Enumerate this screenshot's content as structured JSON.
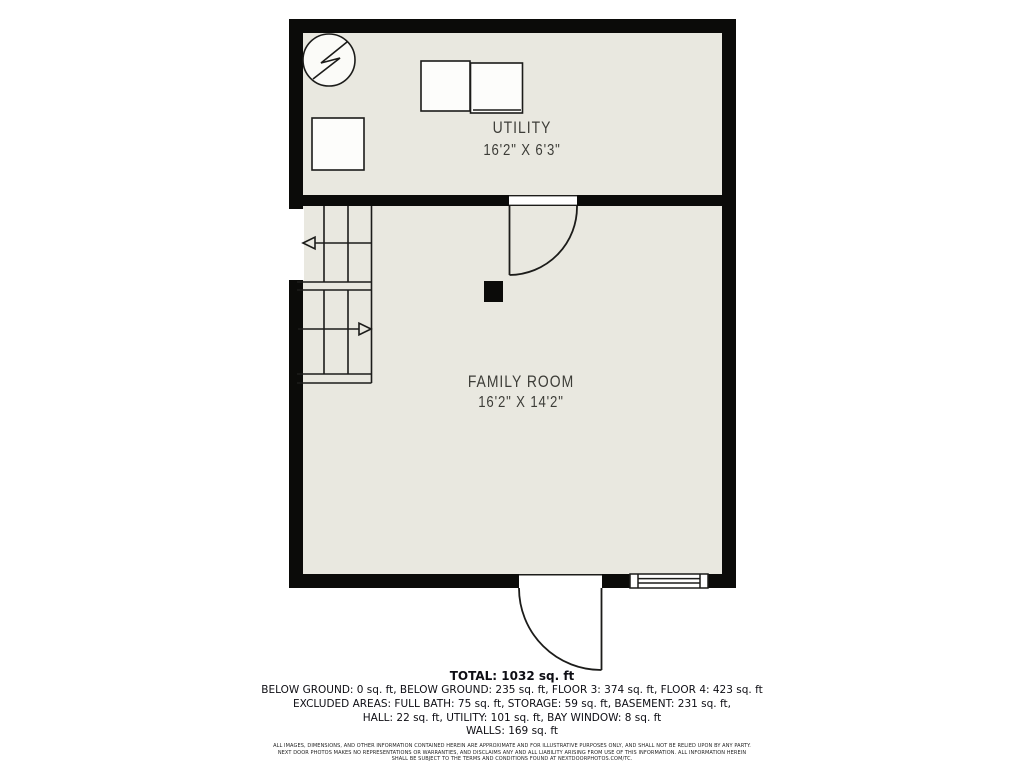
{
  "colors": {
    "page_bg": "#ffffff",
    "floor": "#e9e8e0",
    "wall": "#0b0b09",
    "line": "#1c1c1a",
    "label_text": "#3d3d38",
    "summary_text": "#0e0e14"
  },
  "plan": {
    "rooms": [
      {
        "name": "UTILITY",
        "dims": "16'2\" X 6'3\""
      },
      {
        "name": "FAMILY ROOM",
        "dims": "16'2\" X 14'2\""
      }
    ],
    "symbols": [
      "electrical-panel",
      "appliance-box-left",
      "appliance-box-right",
      "appliance-box-small",
      "staircase-up-arrow",
      "staircase-down-arrow",
      "interior-door-swing",
      "exterior-door-swing",
      "window",
      "support-post"
    ]
  },
  "summary": {
    "total": "TOTAL: 1032 sq. ft",
    "lines": [
      "BELOW GROUND: 0 sq. ft, BELOW GROUND: 235 sq. ft, FLOOR 3: 374 sq. ft, FLOOR 4: 423 sq. ft",
      "EXCLUDED AREAS: FULL BATH: 75 sq. ft, STORAGE: 59 sq. ft, BASEMENT: 231 sq. ft,",
      "HALL: 22 sq. ft, UTILITY: 101 sq. ft, BAY WINDOW: 8 sq. ft",
      "WALLS: 169 sq. ft"
    ]
  },
  "disclaimer": {
    "lines": [
      "ALL IMAGES, DIMENSIONS, AND OTHER INFORMATION CONTAINED HEREIN ARE APPROXIMATE AND FOR ILLUSTRATIVE PURPOSES ONLY, AND SHALL NOT BE RELIED UPON BY ANY PARTY.",
      "NEXT DOOR PHOTOS MAKES NO REPRESENTATIONS OR WARRANTIES, AND DISCLAIMS ANY AND ALL LIABILITY ARISING FROM USE OF THIS INFORMATION. ALL INFORMATION HEREIN",
      "SHALL BE SUBJECT TO THE TERMS AND CONDITIONS FOUND AT NEXTDOORPHOTOS.COM/TC."
    ]
  }
}
